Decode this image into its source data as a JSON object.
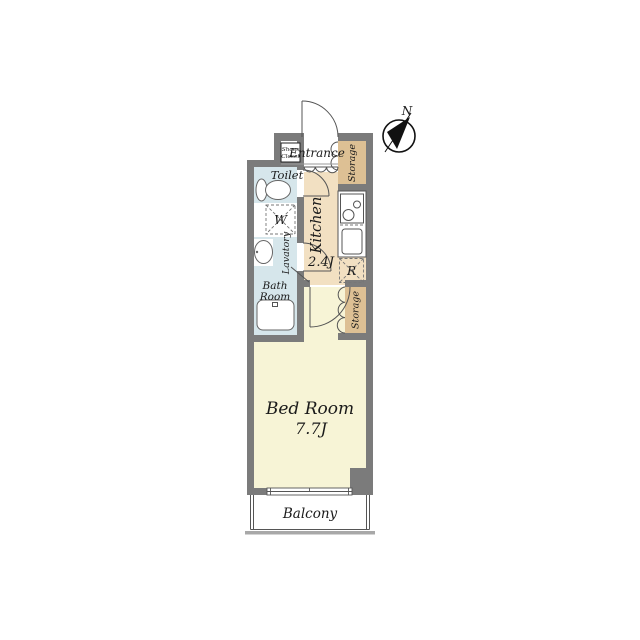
{
  "compass": {
    "north_label": "N"
  },
  "rooms": {
    "entrance": {
      "label": "Entrance"
    },
    "shoes_closet": {
      "line1": "Shoes",
      "line2": "Closet"
    },
    "storage_top": {
      "label": "Storage"
    },
    "storage_lower": {
      "label": "Storage"
    },
    "toilet": {
      "label": "Toilet"
    },
    "washer": {
      "label": "W"
    },
    "lavatory": {
      "label": "Lavatory"
    },
    "bath": {
      "line1": "Bath",
      "line2": "Room"
    },
    "kitchen": {
      "label": "Kitchen",
      "size": "2.4J"
    },
    "refrigerator": {
      "label": "R"
    },
    "bedroom": {
      "label": "Bed Room",
      "size": "7.7J"
    },
    "balcony": {
      "label": "Balcony"
    }
  },
  "colors": {
    "wall": "#7b7b7b",
    "water_room": "#d6e6eb",
    "kitchen_floor": "#f2e0c2",
    "storage": "#ddc094",
    "bedroom_floor": "#f7f4d6",
    "balcony_rail": "#a8a8a8"
  }
}
